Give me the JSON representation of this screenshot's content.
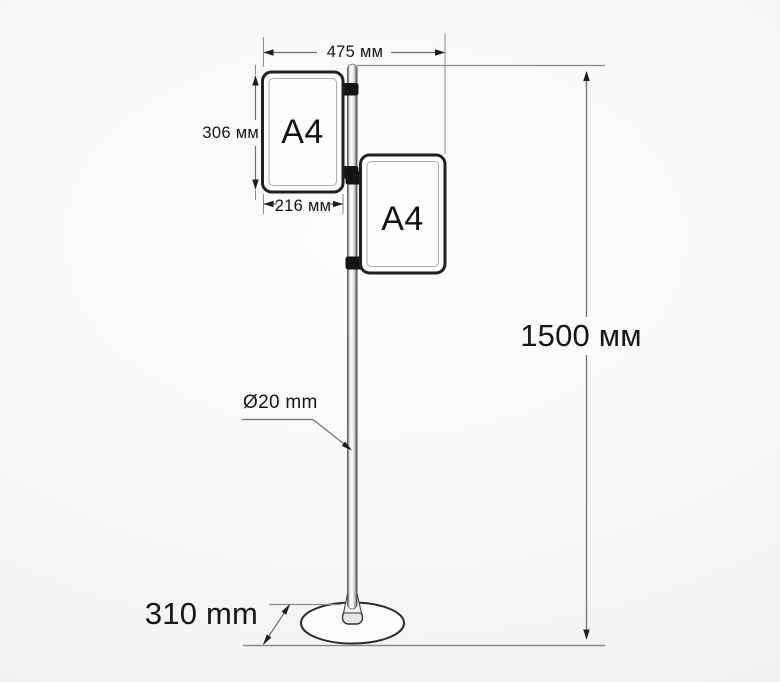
{
  "diagram": {
    "type": "technical-dimension-drawing",
    "subject": "Floor-standing sign holder: pole on round base with two A4 frames"
  },
  "frames": {
    "left": {
      "label": "A4"
    },
    "right": {
      "label": "A4"
    }
  },
  "dimensions": {
    "overall_width": "475 мм",
    "frame_height": "306 мм",
    "frame_width": "216 мм",
    "stand_height": "1500 мм",
    "pole_diameter": "Ø20 mm",
    "base_diameter": "310 mm"
  },
  "colors": {
    "background": "#f6f6f6",
    "dimension_line": "#6f6f6f",
    "extension_line": "#8a8a8a",
    "arrow": "#1c1c1c",
    "frame_border": "#212121",
    "clamp": "#151515",
    "ink": "#1a1a1a"
  }
}
